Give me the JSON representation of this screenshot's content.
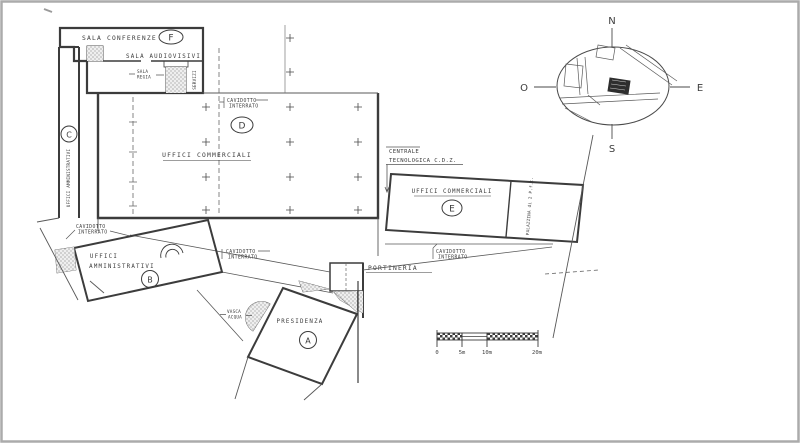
{
  "colors": {
    "ink": "#3c3c3c",
    "thin": "#585858",
    "frame": "#ababab",
    "paper": "#ffffff",
    "site_block": "#2e2e2e"
  },
  "buildings": {
    "f": {
      "letter": "F",
      "name": "SALA CONFERENZE"
    },
    "audio": {
      "name": "SALA AUDIOVISIVI"
    },
    "regia": {
      "l1": "SALA",
      "l2": "REGIA"
    },
    "servizi": {
      "name": "SERVIZI"
    },
    "c": {
      "letter": "C",
      "name": "UFFICI AMMINISTRATIVI"
    },
    "d": {
      "letter": "D",
      "name": "UFFICI COMMERCIALI"
    },
    "e": {
      "letter": "E",
      "name": "UFFICI COMMERCIALI",
      "wing": "PALAZZINA di 2 P.f.t."
    },
    "b": {
      "letter": "B",
      "l1": "UFFICI",
      "l2": "AMMINISTRATIVI"
    },
    "a": {
      "letter": "A",
      "name": "PRESIDENZA"
    },
    "portineria": {
      "name": "PORTINERIA"
    },
    "centrale": {
      "l1": "CENTRALE",
      "l2": "TECNOLOGICA  C.D.Z."
    },
    "vasca": {
      "l1": "VASCA",
      "l2": "ACQUA"
    }
  },
  "notes": {
    "cavidotto_l1": "CAVIDOTTO",
    "cavidotto_l2": "INTERRATO"
  },
  "compass": {
    "n": "N",
    "w": "O",
    "e": "E",
    "s": "S"
  },
  "scalebar": {
    "t0": "0",
    "t1": "5m",
    "t2": "10m",
    "t3": "20m"
  }
}
